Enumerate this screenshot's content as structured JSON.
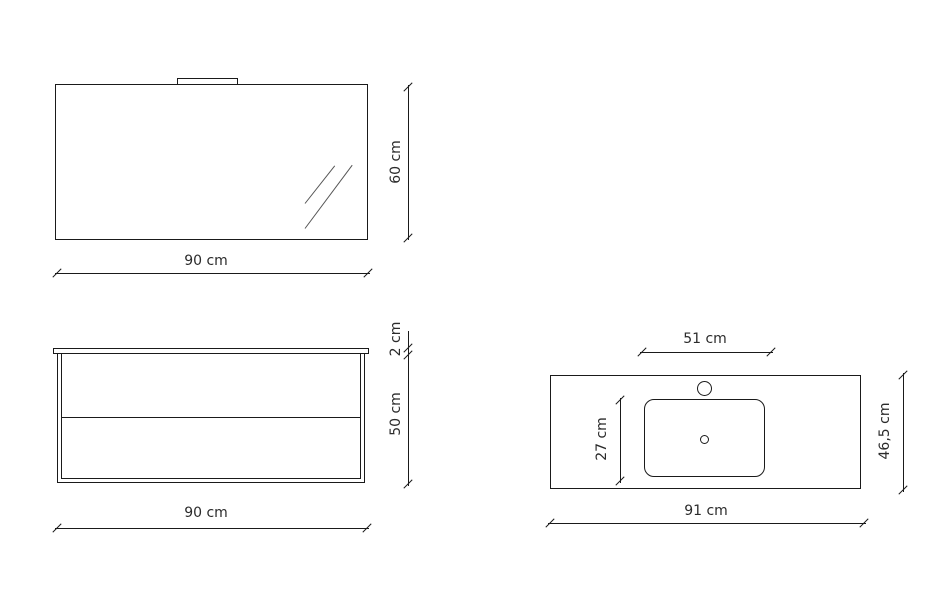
{
  "background_color": "#ffffff",
  "line_color": "#1a1a1a",
  "text_color": "#2b2b2b",
  "figures": {
    "mirror": {
      "width_label": "90 cm",
      "height_label": "60 cm"
    },
    "cabinet": {
      "top_thickness_label": "2 cm",
      "height_label": "50 cm",
      "width_label": "90 cm"
    },
    "washbasin": {
      "basin_width_label": "51 cm",
      "basin_depth_label": "27 cm",
      "counter_depth_label": "46,5 cm",
      "counter_width_label": "91 cm"
    }
  }
}
